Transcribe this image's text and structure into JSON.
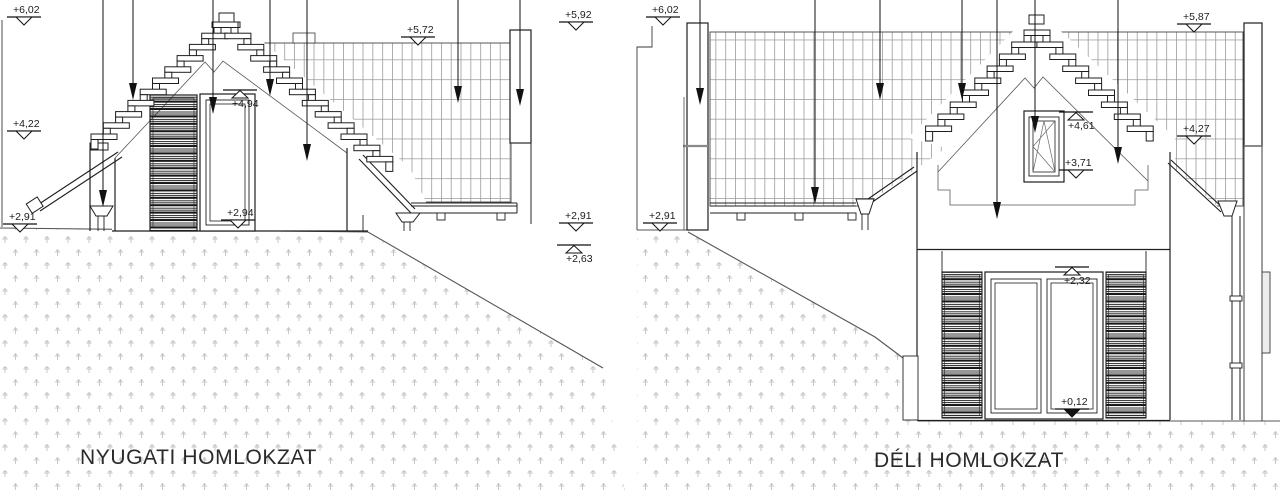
{
  "drawing": {
    "type": "architectural elevation drawing",
    "titles": {
      "west": "NYUGATI HOMLOKZAT",
      "south": "DÉLI HOMLOKZAT"
    }
  },
  "markers": [
    {
      "label": "+6,02",
      "x": 6,
      "y": 5,
      "dir": "down",
      "filled": false
    },
    {
      "label": "+4,22",
      "x": 6,
      "y": 119,
      "dir": "down",
      "filled": false
    },
    {
      "label": "+2,91",
      "x": 2,
      "y": 212,
      "dir": "down",
      "filled": false
    },
    {
      "label": "+5,72",
      "x": 400,
      "y": 25,
      "dir": "down",
      "filled": false
    },
    {
      "label": "+5,92",
      "x": 558,
      "y": 10,
      "dir": "down",
      "filled": false
    },
    {
      "label": "+4,94",
      "x": 222,
      "y": 89,
      "dir": "up",
      "filled": false
    },
    {
      "label": "+2,94",
      "x": 220,
      "y": 208,
      "dir": "down",
      "filled": false
    },
    {
      "label": "+2,91",
      "x": 558,
      "y": 211,
      "dir": "down",
      "filled": false
    },
    {
      "label": "+2,63",
      "x": 556,
      "y": 244,
      "dir": "up",
      "filled": false
    },
    {
      "label": "+6,02",
      "x": 645,
      "y": 5,
      "dir": "down",
      "filled": false
    },
    {
      "label": "+2,91",
      "x": 642,
      "y": 211,
      "dir": "down",
      "filled": false
    },
    {
      "label": "+5,87",
      "x": 1176,
      "y": 12,
      "dir": "down",
      "filled": false
    },
    {
      "label": "+4,27",
      "x": 1176,
      "y": 124,
      "dir": "down",
      "filled": false
    },
    {
      "label": "+4,61",
      "x": 1058,
      "y": 111,
      "dir": "up",
      "filled": false
    },
    {
      "label": "+3,71",
      "x": 1058,
      "y": 158,
      "dir": "down",
      "filled": false
    },
    {
      "label": "+2,32",
      "x": 1054,
      "y": 266,
      "dir": "up",
      "filled": false
    },
    {
      "label": "+0,12",
      "x": 1054,
      "y": 397,
      "dir": "down",
      "filled": true
    }
  ],
  "colors": {
    "ink": "#1f1f1f",
    "thin": "#4a4a4a",
    "grid_line": "#9b9b9b",
    "stipple": "#c3c3c3",
    "joint": "#8a8a8a"
  }
}
